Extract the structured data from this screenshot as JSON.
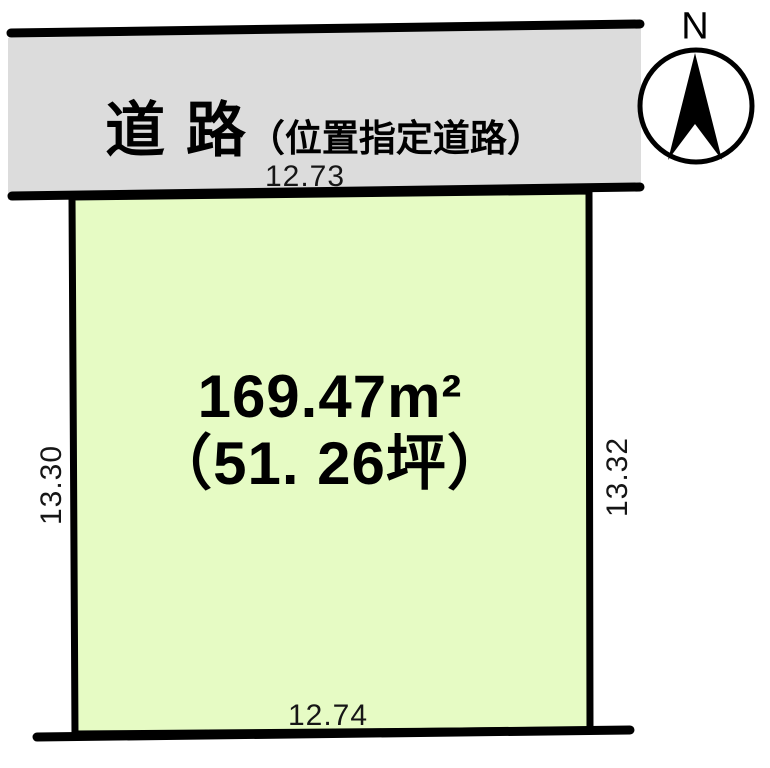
{
  "road": {
    "name": "道 路",
    "type_note": "（位置指定道路）"
  },
  "plot": {
    "area_sqm": "169.47m²",
    "area_tsubo": "（51. 26坪）",
    "dimensions": {
      "top": "12.73",
      "bottom": "12.74",
      "left": "13.30",
      "right": "13.32"
    }
  },
  "compass": {
    "north_label": "N"
  },
  "colors": {
    "road_fill": "#dcdcdc",
    "plot_fill": "#e6fbc4",
    "line": "#000000"
  }
}
